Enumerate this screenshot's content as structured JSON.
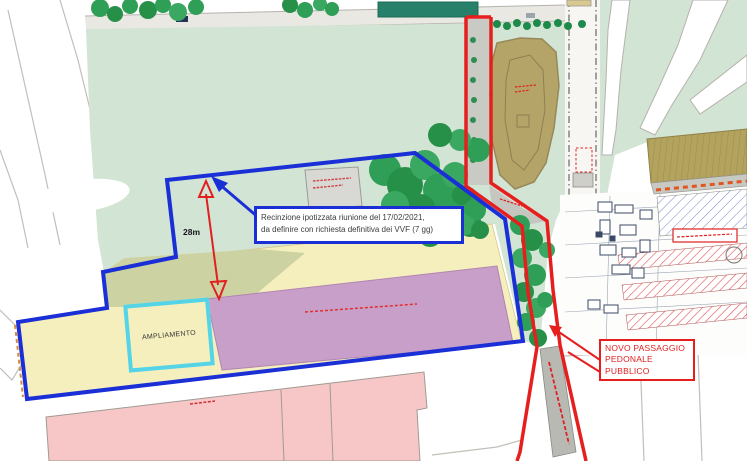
{
  "plan": {
    "fence_note": {
      "line1": "Recinzione ipotizzata riunione del 17/02/2021,",
      "line2": "da definire con richiesta definitiva dei VVF (7 gg)"
    },
    "dimension_label": "28m",
    "expansion_label": "AMPLIAMENTO",
    "passage_label": {
      "line1": "NOVO PASSAGGIO",
      "line2": "PEDONALE",
      "line3": "PUBBLICO"
    }
  },
  "colors": {
    "fence_blue": "#1b2fd6",
    "path_red": "#e61e1e",
    "highlight_cyan": "#54d4e6",
    "zone_yellow": "#f5efbe",
    "zone_olive": "#cdd2a2",
    "zone_purple": "#c89fc8",
    "zone_pink": "#f6c7c6",
    "field_green": "#d2e4d4",
    "dirt_brown": "#b5a468",
    "tan_building": "#b3a35e"
  }
}
